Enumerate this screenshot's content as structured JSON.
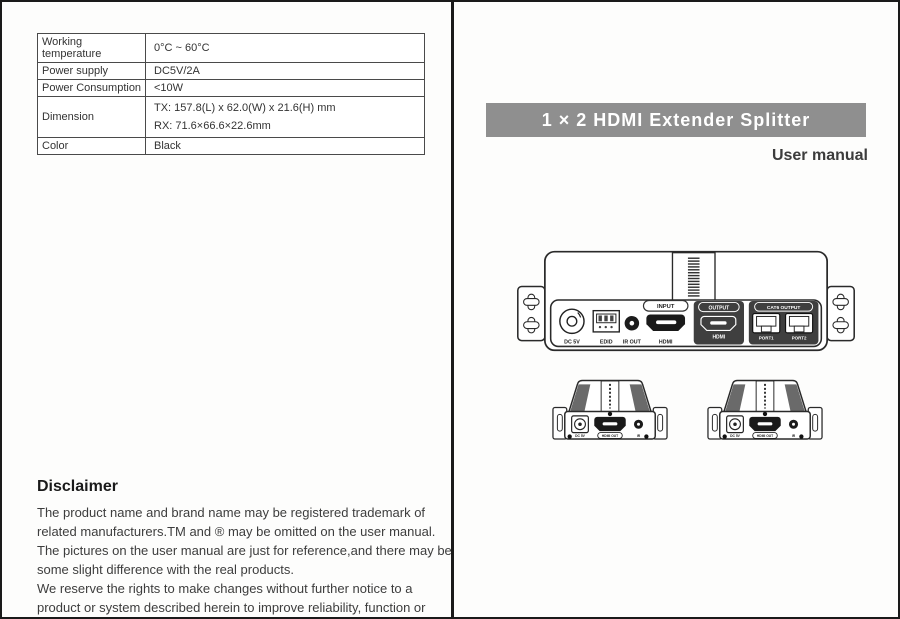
{
  "left": {
    "spec_table": {
      "rows": [
        {
          "label": "Working temperature",
          "value": "0°C ~ 60°C"
        },
        {
          "label": "Power supply",
          "value": "DC5V/2A"
        },
        {
          "label": "Power Consumption",
          "value": "<10W"
        },
        {
          "label": "Dimension",
          "value_tx": "TX: 157.8(L) x 62.0(W) x 21.6(H) mm",
          "value_rx": "RX: 71.6×66.6×22.6mm"
        },
        {
          "label": "Color",
          "value": "Black"
        }
      ]
    },
    "disclaimer": {
      "heading": "Disclaimer",
      "paragraph1": "The product name and brand name may be registered trademark of related manufacturers.TM and ® may be omitted on the user manual. The pictures on the user manual are just for reference,and there may be some slight difference with the real products.",
      "paragraph2": "We reserve the rights to make changes without further notice to a product or system described herein to improve reliability, function or design."
    }
  },
  "right": {
    "title": "1 × 2 HDMI Extender Splitter",
    "subtitle": "User manual",
    "colors": {
      "banner_background": "#8f8f8f",
      "banner_text": "#ffffff",
      "subtitle_text": "#3c3c3c",
      "line_art": "#2a2a2a",
      "dark_panel": "#3f3f3f"
    },
    "transmitter": {
      "labels": {
        "dc": "DC 5V",
        "edid": "EDID",
        "ir_out": "IR OUT",
        "input": "INPUT",
        "hdmi_in": "HDMI",
        "output": "OUTPUT",
        "hdmi_out": "HDMI",
        "cat6": "CAT6 OUTPUT",
        "port1": "PORT1",
        "port2": "PORT2"
      }
    },
    "receivers": [
      {
        "labels": {
          "dc": "DC 5V",
          "hdmi": "HDMI OUT",
          "ir": "IR"
        }
      },
      {
        "labels": {
          "dc": "DC 5V",
          "hdmi": "HDMI OUT",
          "ir": "IR"
        }
      }
    ]
  }
}
